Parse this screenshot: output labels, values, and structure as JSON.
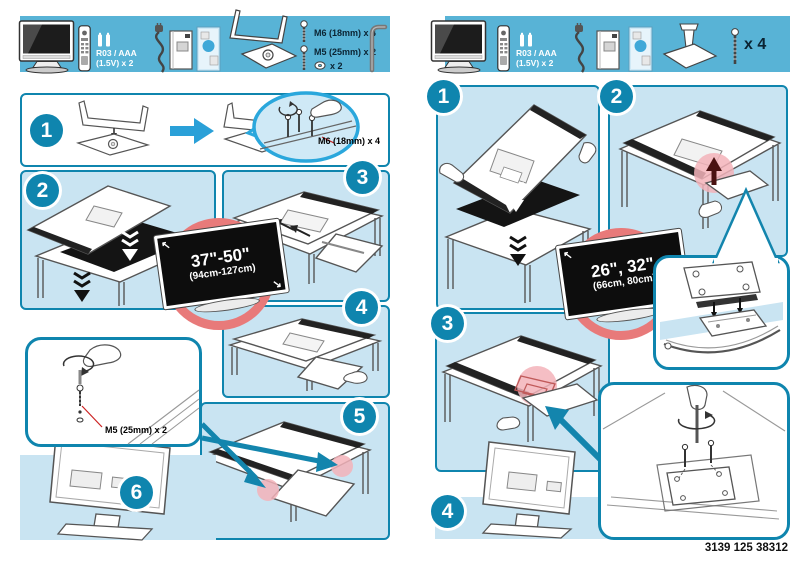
{
  "colors": {
    "bar_blue": "#58B3D6",
    "panel_blue": "#C9E4F2",
    "teal": "#0F85AE",
    "balloon_blue": "#2AA7DC",
    "red_ring": "#E87A7A",
    "pink_highlight": "#F3B3BA",
    "annotation_red": "#CC2222"
  },
  "left_page": {
    "parts_bar": {
      "battery_label_line1": "R03 / AAA",
      "battery_label_line2": "(1.5V) x 2",
      "screw_m6": "M6 (18mm) x 4",
      "screw_m5": "M5 (25mm) x 2",
      "washer_count": "x 2"
    },
    "step1": {
      "number": "1",
      "screw_annotation": "M6 (18mm) x 4"
    },
    "step2": {
      "number": "2"
    },
    "step3": {
      "number": "3"
    },
    "step4": {
      "number": "4"
    },
    "step5": {
      "number": "5"
    },
    "step6": {
      "number": "6"
    },
    "size_callout": {
      "size_inches": "37\"-50\"",
      "size_cm": "(94cm-127cm)"
    },
    "detail_callout": {
      "screw_annotation": "M5 (25mm) x 2"
    }
  },
  "right_page": {
    "parts_bar": {
      "battery_label_line1": "R03 / AAA",
      "battery_label_line2": "(1.5V) x 2",
      "screw_count": "x 4"
    },
    "step1": {
      "number": "1"
    },
    "step2": {
      "number": "2"
    },
    "step3": {
      "number": "3"
    },
    "step4": {
      "number": "4"
    },
    "size_callout": {
      "size_inches": "26\", 32\"",
      "size_cm": "(66cm, 80cm)"
    }
  },
  "footer": {
    "document_number": "3139 125 38312"
  }
}
